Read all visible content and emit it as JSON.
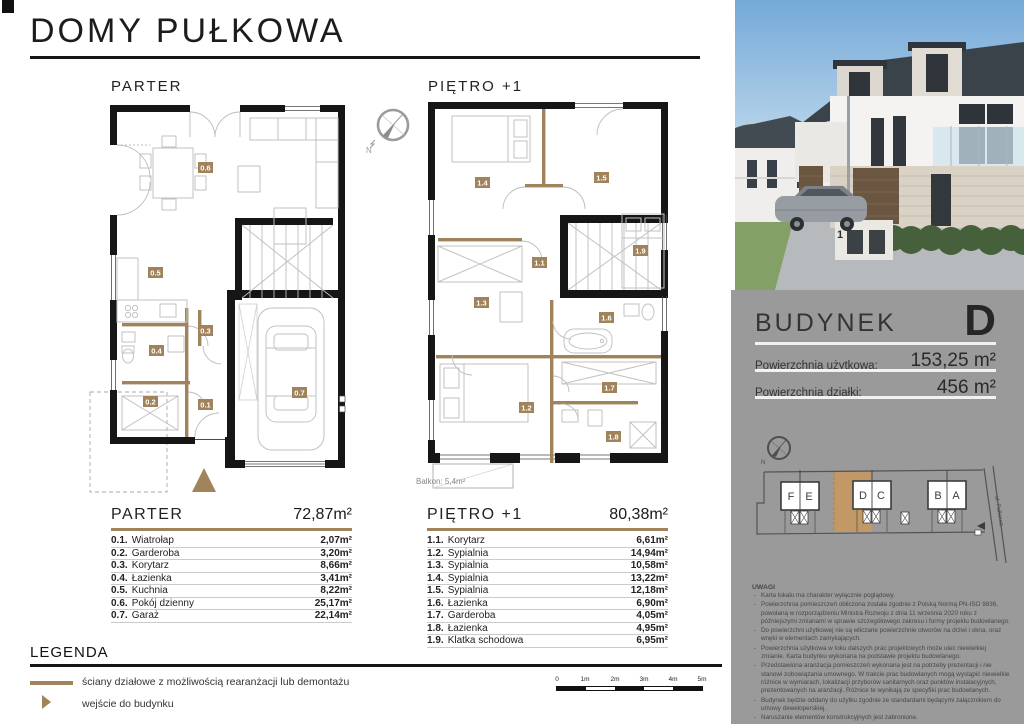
{
  "page": {
    "title": "DOMY PUŁKOWA"
  },
  "plans": {
    "compass_label": "N",
    "parter": {
      "title": "PARTER",
      "total_area": "72,87m²",
      "tags": [
        "0.1",
        "0.2",
        "0.3",
        "0.4",
        "0.5",
        "0.6",
        "0.7"
      ],
      "rooms": [
        {
          "num": "0.1.",
          "name": "Wiatrołap",
          "area": "2,07m²"
        },
        {
          "num": "0.2.",
          "name": "Garderoba",
          "area": "3,20m²"
        },
        {
          "num": "0.3.",
          "name": "Korytarz",
          "area": "8,66m²"
        },
        {
          "num": "0.4.",
          "name": "Łazienka",
          "area": "3,41m²"
        },
        {
          "num": "0.5.",
          "name": "Kuchnia",
          "area": "8,22m²"
        },
        {
          "num": "0.6.",
          "name": "Pokój dzienny",
          "area": "25,17m²"
        },
        {
          "num": "0.7.",
          "name": "Garaż",
          "area": "22,14m²"
        }
      ]
    },
    "pietro": {
      "title": "PIĘTRO +1",
      "total_area": "80,38m²",
      "balcony_label": "Balkon: 5,4m²",
      "tags": [
        "1.1",
        "1.2",
        "1.3",
        "1.4",
        "1.5",
        "1.6",
        "1.7",
        "1.8",
        "1.9"
      ],
      "rooms": [
        {
          "num": "1.1.",
          "name": "Korytarz",
          "area": "6,61m²"
        },
        {
          "num": "1.2.",
          "name": "Sypialnia",
          "area": "14,94m²"
        },
        {
          "num": "1.3.",
          "name": "Sypialnia",
          "area": "10,58m²"
        },
        {
          "num": "1.4.",
          "name": "Sypialnia",
          "area": "13,22m²"
        },
        {
          "num": "1.5.",
          "name": "Sypialnia",
          "area": "12,18m²"
        },
        {
          "num": "1.6.",
          "name": "Łazienka",
          "area": "6,90m²"
        },
        {
          "num": "1.7.",
          "name": "Garderoba",
          "area": "4,05m²"
        },
        {
          "num": "1.8.",
          "name": "Łazienka",
          "area": "4,95m²"
        },
        {
          "num": "1.9.",
          "name": "Klatka schodowa",
          "area": "6,95m²"
        }
      ]
    }
  },
  "panel": {
    "photo_house_number": "1",
    "building_label": "BUDYNEK",
    "building_letter": "D",
    "area_rows": [
      {
        "label": "Powierzchnia użytkowa:",
        "value": "153,25 m²"
      },
      {
        "label": "Powierzchnia działki:",
        "value": "456 m²"
      }
    ],
    "site_plan": {
      "buildings": [
        "F",
        "E",
        "D",
        "C",
        "B",
        "A"
      ],
      "highlighted": "D",
      "street": "ul. Pułkowa",
      "compass_label": "N"
    },
    "uwagi": {
      "title": "UWAGI",
      "items": [
        "Karta lokalu ma charakter wyłącznie poglądowy.",
        "Powierzchnia pomieszczeń obliczona została zgodnie z Polską Normą PN-ISO 9836, powołaną w rozporządzeniu Ministra Rozwoju z dnia 11 września 2020 roku z późniejszymi zmianami w sprawie szczegółowego zakresu i formy projektu budowlanego.",
        "Do powierzchni użytkowej nie są wliczane powierzchnie otworów na drzwi i okna, oraz wnęki w elementach zamykających.",
        "Powierzchnia użytkowa w toku dalszych prac projektowych może ulec niewielkiej zmianie. Karta budynku wykonana na podstawie projektu budowlanego.",
        "Przedstawiona aranżacja pomieszczeń wykonana jest na potrzeby prezentacji i nie stanowi zobowiązania umownego. W trakcie prac budowlanych mogą wystąpić niewielkie różnice w wymiarach, lokalizacji przyborów sanitarnych oraz punktów instalacyjnych, prezentowanych na aranżacji. Różnice te wynikają ze specyfiki prac budowlanych.",
        "Budynek będzie oddany do użytku zgodnie ze standardami będącymi załącznikiem do umowy deweloperskiej.",
        "Naruszanie elementów konstrukcyjnych jest zabronione."
      ]
    }
  },
  "legend": {
    "title": "LEGENDA",
    "items": [
      {
        "label": "ściany działowe z możliwością rearanżacji lub demontażu"
      },
      {
        "label": "wejście do budynku"
      }
    ]
  },
  "scale_bar": {
    "labels": [
      "0",
      "1m",
      "2m",
      "3m",
      "4m",
      "5m"
    ]
  },
  "colors": {
    "tan": "#a0835a",
    "highlight": "#c9995d",
    "panel_gray": "#9a9a9a",
    "wall_black": "#161616"
  }
}
